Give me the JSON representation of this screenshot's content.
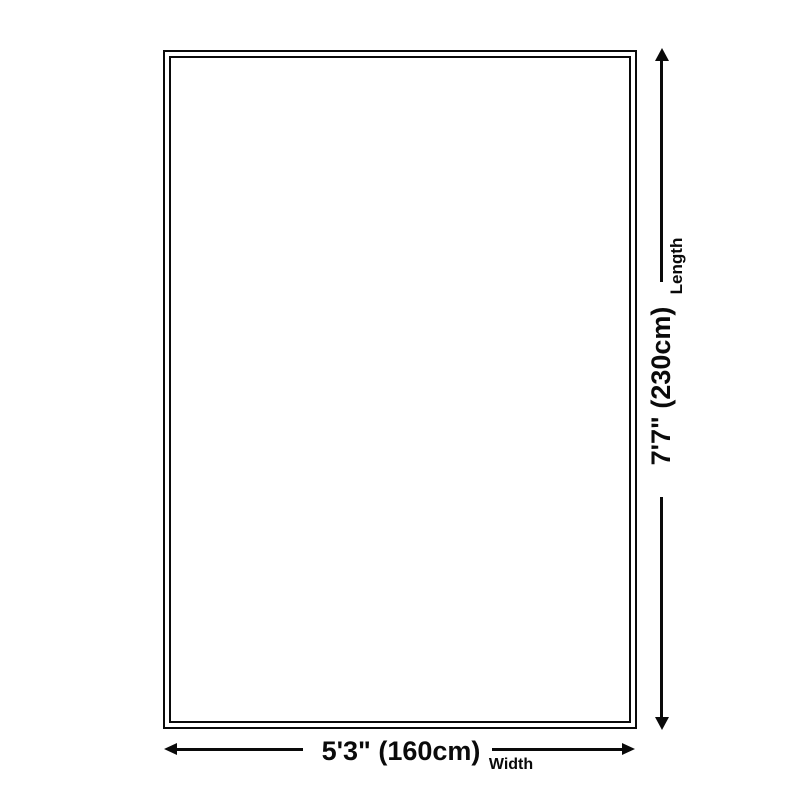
{
  "diagram": {
    "type": "product-dimension-diagram",
    "length": {
      "label": "Length",
      "value": "7'7\" (230cm)"
    },
    "width": {
      "label": "Width",
      "value": "5'3\" (160cm)"
    },
    "colors": {
      "line": "#0a0a0a",
      "background": "#ffffff"
    }
  }
}
